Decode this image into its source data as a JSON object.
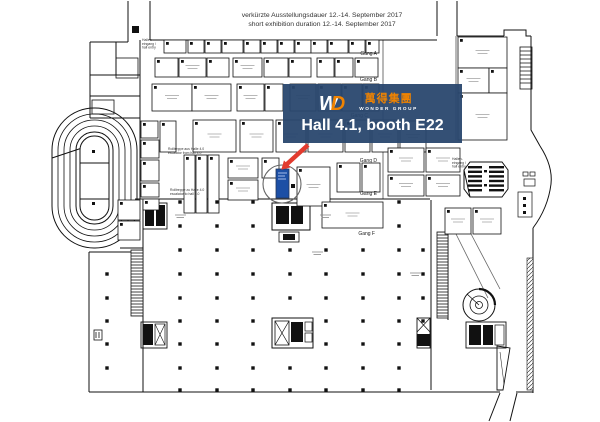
{
  "header": {
    "line1": "verkürzte Ausstellungsdauer 12.-14. September 2017",
    "line2": "short exhibition duration 12.-14. September 2017"
  },
  "banner": {
    "monogram_w": "W",
    "monogram_d": "D",
    "chinese": "萬得集團",
    "group_name": "WONDER GROUP",
    "location": "Hall 4.1, booth E22",
    "bg_color": "#29476e",
    "orange": "#f08300",
    "red": "#e23b2e",
    "booth_blue": "#1c4fa5",
    "highlight_booth": "E22"
  },
  "plan": {
    "aisle_labels": [
      {
        "text": "Gang A",
        "x": 377,
        "y": 55
      },
      {
        "text": "Gang B",
        "x": 377,
        "y": 81
      },
      {
        "text": "Gang C",
        "x": 368,
        "y": 117
      },
      {
        "text": "Gang D",
        "x": 377,
        "y": 162
      },
      {
        "text": "Gang E",
        "x": 377,
        "y": 195
      },
      {
        "text": "Gang F",
        "x": 375,
        "y": 235
      }
    ],
    "notes": [
      {
        "x": 142,
        "y": 41,
        "lines": [
          "Hallen-",
          "eingang /",
          "hall entry"
        ]
      },
      {
        "x": 168,
        "y": 150,
        "lines": [
          "Rolltreppe aus Halle 4.0",
          "escalator from hall 4.0"
        ]
      },
      {
        "x": 170,
        "y": 191,
        "lines": [
          "Rolltreppe zu Halle 4.0",
          "escalator to hall 4.0"
        ]
      },
      {
        "x": 452,
        "y": 160,
        "lines": [
          "Hallen-",
          "eingang /",
          "hall entry"
        ]
      }
    ],
    "floor_marks": [
      [
        175,
        215
      ],
      [
        320,
        215
      ],
      [
        312,
        252
      ],
      [
        410,
        273
      ]
    ],
    "booths": [
      [
        164,
        40,
        22,
        13
      ],
      [
        188,
        40,
        16,
        13
      ],
      [
        205,
        40,
        16,
        13
      ],
      [
        222,
        40,
        21,
        13
      ],
      [
        244,
        40,
        16,
        13
      ],
      [
        261,
        40,
        16,
        13
      ],
      [
        278,
        40,
        16,
        13
      ],
      [
        295,
        40,
        16,
        13
      ],
      [
        311,
        40,
        16,
        13
      ],
      [
        328,
        40,
        20,
        13
      ],
      [
        349,
        40,
        16,
        13
      ],
      [
        366,
        40,
        13,
        13
      ],
      [
        155,
        58,
        23,
        19
      ],
      [
        179,
        58,
        27,
        19
      ],
      [
        207,
        58,
        22,
        19
      ],
      [
        233,
        58,
        29,
        19
      ],
      [
        264,
        58,
        24,
        19
      ],
      [
        289,
        58,
        22,
        19
      ],
      [
        317,
        58,
        17,
        19
      ],
      [
        335,
        58,
        18,
        19
      ],
      [
        355,
        58,
        23,
        19
      ],
      [
        152,
        84,
        40,
        27
      ],
      [
        192,
        84,
        39,
        27
      ],
      [
        237,
        84,
        27,
        27
      ],
      [
        265,
        84,
        18,
        27
      ],
      [
        290,
        84,
        26,
        27
      ],
      [
        318,
        84,
        23,
        27
      ],
      [
        342,
        84,
        20,
        27
      ],
      [
        363,
        84,
        16,
        27
      ],
      [
        160,
        121,
        16,
        31
      ],
      [
        193,
        120,
        43,
        32
      ],
      [
        240,
        120,
        33,
        32
      ],
      [
        276,
        120,
        30,
        32
      ],
      [
        308,
        120,
        35,
        32
      ],
      [
        345,
        120,
        25,
        32
      ],
      [
        372,
        120,
        26,
        32
      ],
      [
        400,
        121,
        26,
        31
      ],
      [
        141,
        121,
        17,
        17
      ],
      [
        141,
        140,
        18,
        18
      ],
      [
        141,
        160,
        18,
        21
      ],
      [
        141,
        183,
        18,
        14
      ],
      [
        143,
        199,
        16,
        11
      ],
      [
        184,
        155,
        11,
        58
      ],
      [
        196,
        155,
        11,
        58
      ],
      [
        208,
        155,
        11,
        58
      ],
      [
        228,
        158,
        30,
        20
      ],
      [
        228,
        180,
        30,
        20
      ],
      [
        262,
        158,
        17,
        20
      ],
      [
        297,
        167,
        33,
        39
      ],
      [
        337,
        163,
        23,
        29
      ],
      [
        362,
        163,
        18,
        29
      ],
      [
        388,
        148,
        36,
        24
      ],
      [
        426,
        148,
        34,
        24
      ],
      [
        388,
        175,
        36,
        21
      ],
      [
        426,
        175,
        34,
        21
      ],
      [
        322,
        202,
        61,
        26
      ],
      [
        445,
        208,
        26,
        26
      ],
      [
        473,
        208,
        28,
        26
      ],
      [
        458,
        37,
        49,
        31
      ],
      [
        458,
        68,
        31,
        25
      ],
      [
        489,
        68,
        18,
        25
      ],
      [
        458,
        93,
        49,
        47
      ],
      [
        118,
        200,
        22,
        20
      ],
      [
        118,
        221,
        22,
        19
      ]
    ],
    "columns": [
      [
        180,
        202
      ],
      [
        217,
        202
      ],
      [
        253,
        202
      ],
      [
        399,
        202
      ],
      [
        180,
        226
      ],
      [
        217,
        226
      ],
      [
        253,
        226
      ],
      [
        399,
        226
      ],
      [
        180,
        250
      ],
      [
        217,
        250
      ],
      [
        253,
        250
      ],
      [
        290,
        250
      ],
      [
        326,
        250
      ],
      [
        363,
        250
      ],
      [
        399,
        250
      ],
      [
        423,
        250
      ],
      [
        107,
        274
      ],
      [
        180,
        274
      ],
      [
        217,
        274
      ],
      [
        253,
        274
      ],
      [
        290,
        274
      ],
      [
        326,
        274
      ],
      [
        363,
        274
      ],
      [
        399,
        274
      ],
      [
        423,
        274
      ],
      [
        107,
        298
      ],
      [
        180,
        298
      ],
      [
        217,
        298
      ],
      [
        253,
        298
      ],
      [
        290,
        298
      ],
      [
        326,
        298
      ],
      [
        363,
        298
      ],
      [
        399,
        298
      ],
      [
        423,
        298
      ],
      [
        107,
        321
      ],
      [
        180,
        321
      ],
      [
        217,
        321
      ],
      [
        253,
        321
      ],
      [
        326,
        321
      ],
      [
        363,
        321
      ],
      [
        399,
        321
      ],
      [
        423,
        321
      ],
      [
        107,
        344
      ],
      [
        180,
        344
      ],
      [
        217,
        344
      ],
      [
        253,
        344
      ],
      [
        326,
        344
      ],
      [
        363,
        344
      ],
      [
        399,
        344
      ],
      [
        107,
        368
      ],
      [
        180,
        368
      ],
      [
        217,
        368
      ],
      [
        253,
        368
      ],
      [
        290,
        368
      ],
      [
        326,
        368
      ],
      [
        363,
        368
      ],
      [
        399,
        368
      ],
      [
        180,
        390
      ],
      [
        217,
        390
      ],
      [
        253,
        390
      ],
      [
        290,
        390
      ],
      [
        326,
        390
      ],
      [
        363,
        390
      ],
      [
        399,
        390
      ]
    ]
  }
}
